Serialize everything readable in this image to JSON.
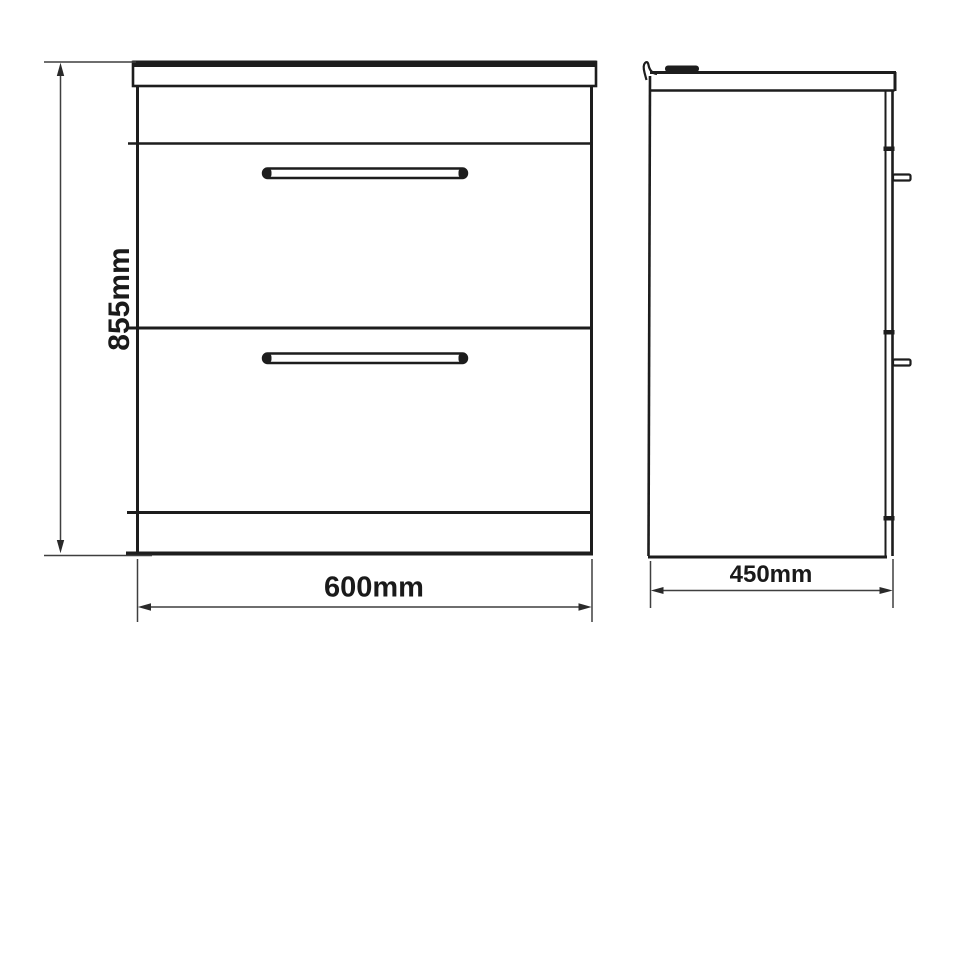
{
  "drawing": {
    "type": "technical-dimension-drawing",
    "subject": "two-drawer floor-standing vanity unit, front and side elevation",
    "background_color": "#ffffff",
    "ink_color": "#1d1d1d",
    "dim_line_color": "#3f3f3f",
    "unit": "mm",
    "dimensions": {
      "height": {
        "label": "855mm",
        "value_mm": 855,
        "orientation": "vertical"
      },
      "width": {
        "label": "600mm",
        "value_mm": 600,
        "orientation": "horizontal"
      },
      "depth": {
        "label": "450mm",
        "value_mm": 450,
        "orientation": "horizontal"
      }
    }
  }
}
